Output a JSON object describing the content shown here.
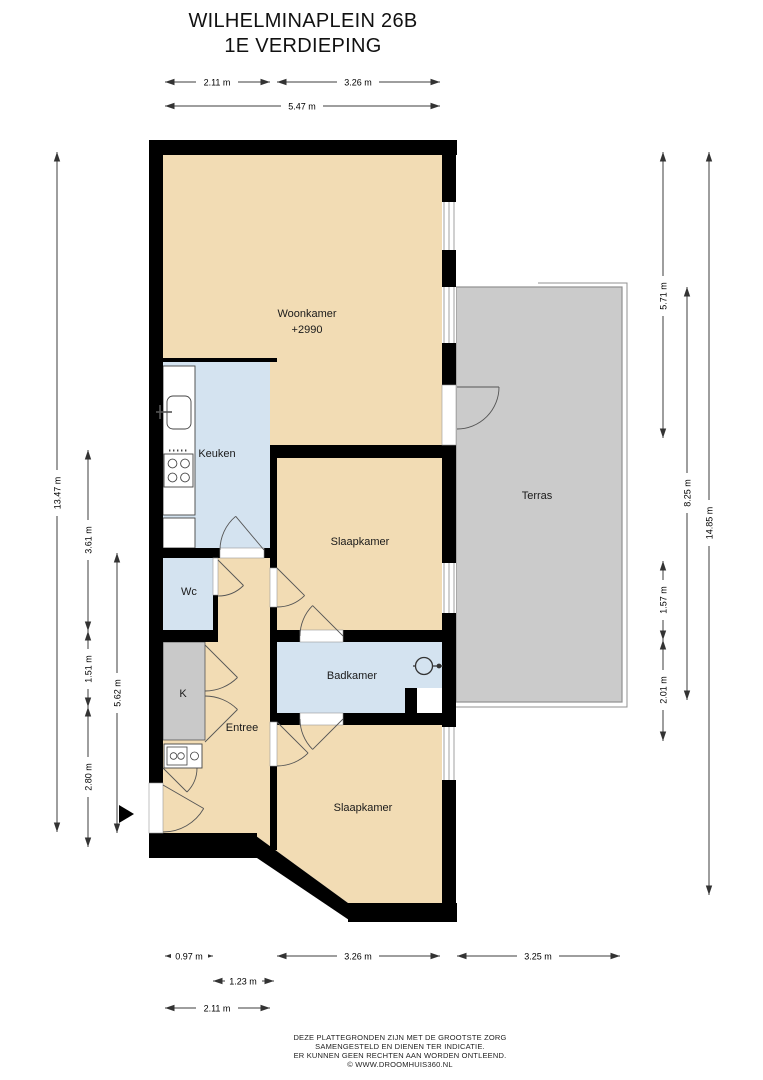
{
  "title": {
    "line1": "WILHELMINAPLEIN 26B",
    "line2": "1E VERDIEPING"
  },
  "rooms": {
    "woonkamer": {
      "label": "Woonkamer",
      "elevation": "+2990"
    },
    "keuken": {
      "label": "Keuken"
    },
    "wc": {
      "label": "Wc"
    },
    "kast": {
      "label": "K"
    },
    "entree": {
      "label": "Entree"
    },
    "badkamer": {
      "label": "Badkamer"
    },
    "slaapkamer1": {
      "label": "Slaapkamer"
    },
    "slaapkamer2": {
      "label": "Slaapkamer"
    },
    "terras": {
      "label": "Terras"
    }
  },
  "dims": {
    "top": {
      "d1": "2.11 m",
      "d2": "3.26 m",
      "d3": "5.47 m"
    },
    "left": {
      "d1": "13.47 m",
      "d2": "3.61 m",
      "d3": "1.51 m",
      "d4": "2.80 m",
      "d5": "5.62 m"
    },
    "right": {
      "d1": "5.71 m",
      "d2": "8.25 m",
      "d3": "14.85 m",
      "d4": "1.57 m",
      "d5": "2.01 m"
    },
    "bottom": {
      "d1": "0.97 m",
      "d2": "3.26 m",
      "d3": "3.25 m",
      "d4": "1.23 m",
      "d5": "2.11 m"
    }
  },
  "footer": {
    "line1": "DEZE PLATTEGRONDEN ZIJN MET DE GROOTSTE ZORG",
    "line2": "SAMENGESTELD EN DIENEN TER INDICATIE.",
    "line3": "ER KUNNEN GEEN RECHTEN AAN WORDEN ONTLEEND.",
    "line4": "© WWW.DROOMHUIS360.NL"
  },
  "colors": {
    "wall": "#000000",
    "room_fill": "#f2dcb4",
    "wet_room_fill": "#d4e3f0",
    "terrace_fill": "#cbcbcb",
    "closet_fill": "#c9c9c9"
  }
}
